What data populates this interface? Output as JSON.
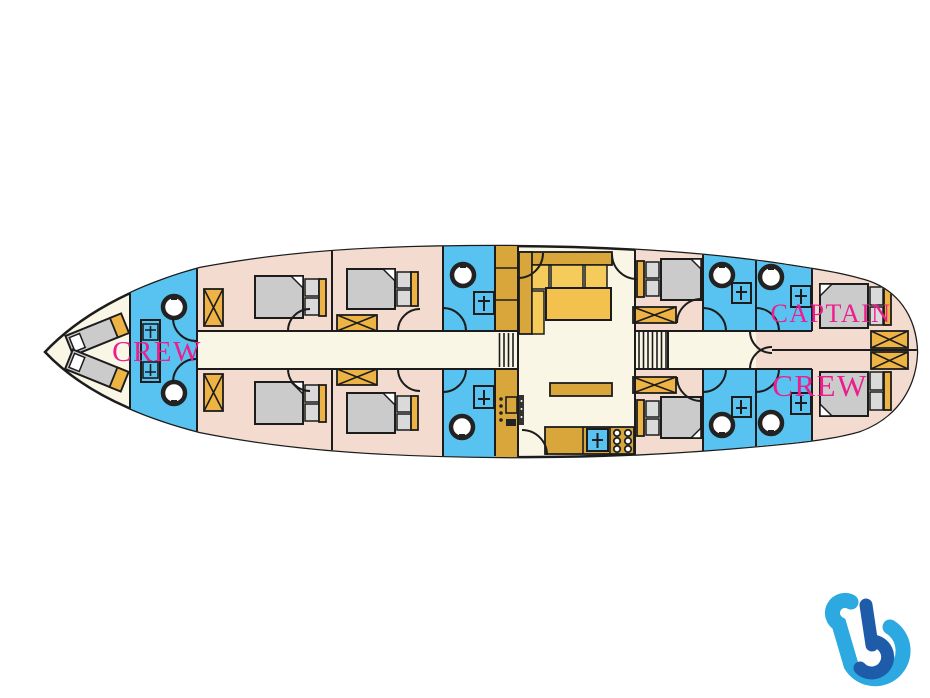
{
  "plan": {
    "labels": {
      "bow_crew": "CREW",
      "captain": "CAPTAIN",
      "aft_crew": "CREW"
    },
    "colors": {
      "floor_cream": "#F9F6E6",
      "cabin_pink": "#F3DCCF",
      "bathroom_blue": "#58C3F0",
      "furniture_gold": "#EDB345",
      "counter_mustard": "#D9A63C",
      "mattress_gray": "#CBCBCB",
      "outline_dark": "#1C1C1C",
      "label_magenta": "#EC1E8D",
      "logo_light_blue": "#2CA9E1",
      "logo_dark_blue": "#1E5CA9"
    },
    "icons": {
      "logo": "b-logo"
    }
  }
}
